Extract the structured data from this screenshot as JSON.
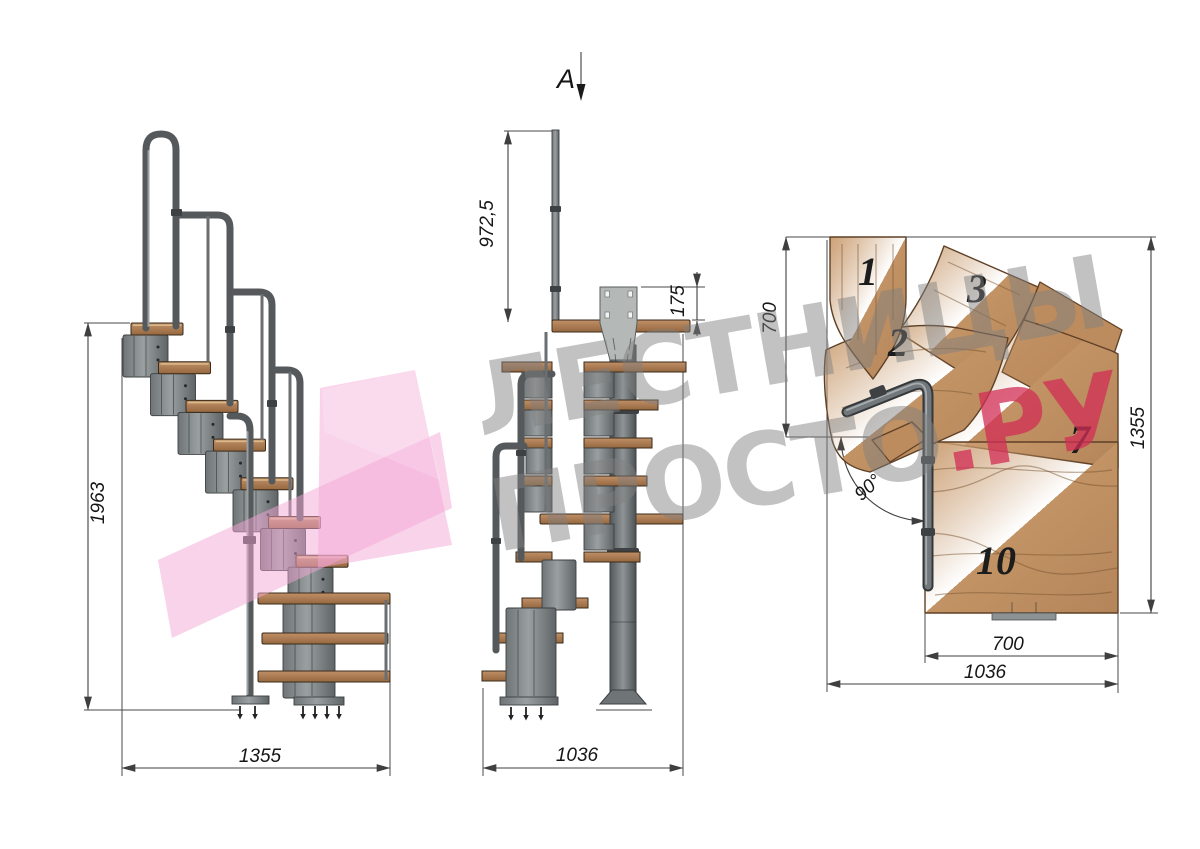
{
  "section_marker": {
    "label": "A"
  },
  "side_view": {
    "dim_total_height": "1963",
    "dim_total_depth": "1355"
  },
  "front_view": {
    "dim_rail_post_height": "972,5",
    "dim_bracket_offset": "175",
    "dim_total_width": "1036"
  },
  "plan_view": {
    "dim_top_run": "700",
    "dim_total_depth": "1355",
    "dim_bottom_run": "700",
    "dim_total_width": "1036",
    "dim_turn_angle": "90°",
    "step_labels": {
      "s1": "1",
      "s2": "2",
      "s3": "3",
      "s7": "7",
      "s10": "10"
    }
  },
  "watermark": {
    "line1": "ЛЕСТНИЦЫ",
    "line2_gray": "ПРОСТО",
    "line2_accent": ".РУ",
    "gray_color": "#7f7f7f",
    "accent_color": "#d22d55",
    "shape_color": "#f4a8d6"
  }
}
